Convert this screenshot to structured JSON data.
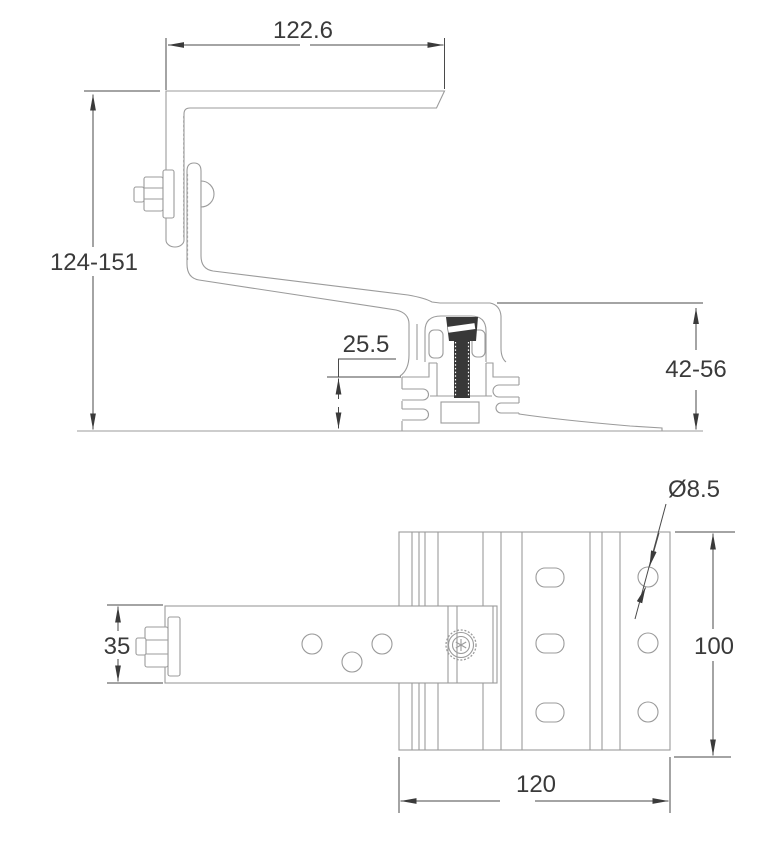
{
  "drawing": {
    "side_view": {
      "width_top": "122.6",
      "height_overall": "124-151",
      "height_base_profile": "25.5",
      "height_rail_range": "42-56"
    },
    "top_view": {
      "hole_diameter": "Ø8.5",
      "arm_width": "35",
      "plate_length": "100",
      "plate_width": "120"
    }
  }
}
